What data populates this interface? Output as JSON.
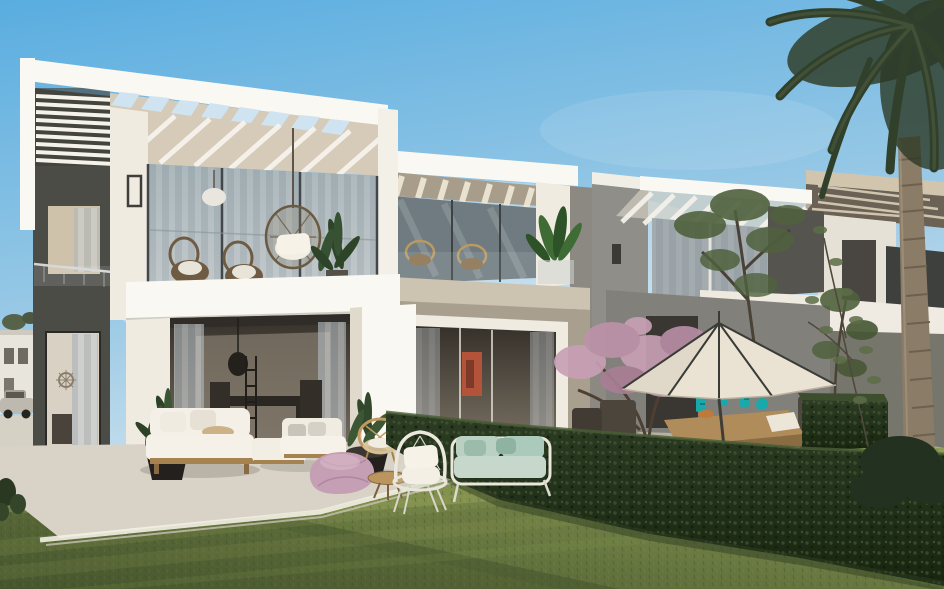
{
  "scene": {
    "sky": {
      "top": "#59ade0",
      "mid": "#9ecbe6",
      "horizon": "#e8f0f2",
      "haze": "#ffffff"
    },
    "villas": {
      "white_bright": "#faf8f2",
      "white_wall": "#efebe1",
      "white_shadow": "#d9d3c6",
      "beige_inner": "#d5cbb8",
      "taupe_slab": "#cdc3b1",
      "taupe_wall": "#a99f8e",
      "gray_wall": "#8f8e88",
      "gray_wall_dark": "#82807a",
      "dark_tower": "#4b4c46",
      "dark_building": "#3d403d",
      "beige_pergola": "#d2c5ad",
      "pergola_underside": "#6b6154",
      "interior_top": "#35302a",
      "interior_bottom": "#7d7466",
      "artwork_red": "#b3543a"
    },
    "glass": {
      "pane": "#9cabb2",
      "pane_dark": "#6f7b80",
      "curtain_light": "#cbcfd1",
      "curtain_dark": "#aeb6ba",
      "mullion": "#43474a"
    },
    "landscape": {
      "lawn_bright": "#8d9b55",
      "lawn_mid": "#7d8c4b",
      "lawn_dark": "#4d5c31",
      "lawn_shadow": "#3f4f2a",
      "hedge_top": "#3c4e2e",
      "hedge_mid": "#2c3d24",
      "hedge_dark": "#18250f",
      "hedge_highlight": "#4a5e37",
      "tree_green": "#4f613d",
      "palm_green": "#31402b",
      "palm_trunk": "#8b7c68",
      "blossom_pink": "#c8a0b5",
      "blossom_deep": "#a87e95",
      "branch_brown": "#4d3f34"
    },
    "terrace": {
      "pavement": "#d8d3c6",
      "pavement_edge": "#f3efe4",
      "stone_back": "#b7b1a4"
    },
    "furniture": {
      "sofa_white": "#f4f0e7",
      "cushion_mint": "#b9d0c3",
      "cushion_mint_deep": "#9bbcaa",
      "beanbag_pink": "#c59fb3",
      "wood": "#b08c5a",
      "wood_dark": "#8a6c42",
      "rattan": "#c09a62",
      "planter_black": "#23201d",
      "umbrella_canopy": "#eae3d4",
      "umbrella_rib": "#3a3a36",
      "vase_teal": "#17a9ab",
      "car_body": "#bdb9af"
    }
  }
}
